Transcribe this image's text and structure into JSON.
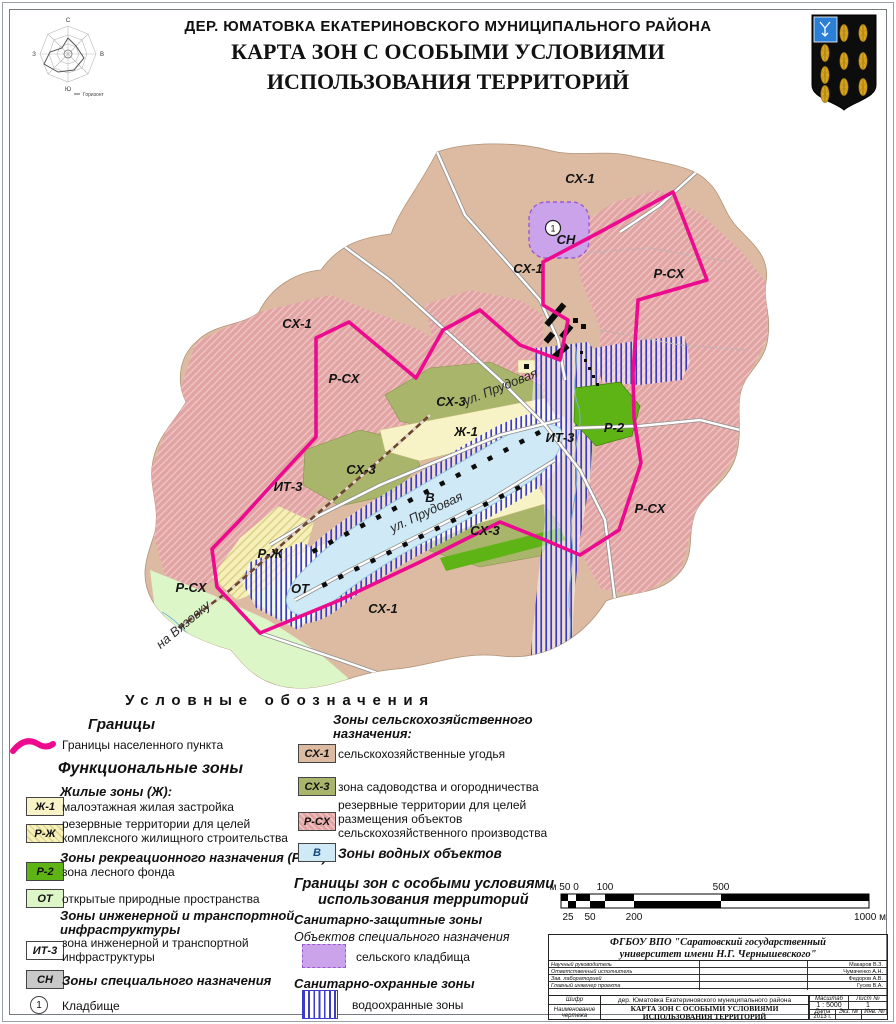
{
  "header": {
    "title_line1": "ДЕР. ЮМАТОВКА ЕКАТЕРИНОВСКОГО МУНИЦИПАЛЬНОГО РАЙОНА",
    "title_line2": "КАРТА ЗОН С ОСОБЫМИ УСЛОВИЯМИ",
    "title_line3": "ИСПОЛЬЗОВАНИЯ ТЕРРИТОРИЙ",
    "windrose": {
      "n": "С",
      "e": "В",
      "s": "Ю",
      "w": "З",
      "caption": "Горизонт"
    }
  },
  "map": {
    "cemetery_marker": "1",
    "labels": [
      {
        "text": "СХ-1",
        "x": 580,
        "y": 53
      },
      {
        "text": "СН",
        "x": 566,
        "y": 114
      },
      {
        "text": "СХ-1",
        "x": 528,
        "y": 143
      },
      {
        "text": "Р-СХ",
        "x": 669,
        "y": 148
      },
      {
        "text": "СХ-1",
        "x": 297,
        "y": 198
      },
      {
        "text": "Р-СХ",
        "x": 344,
        "y": 253
      },
      {
        "text": "СХ-3",
        "x": 451,
        "y": 276
      },
      {
        "text": "Ж-1",
        "x": 466,
        "y": 306
      },
      {
        "text": "ИТ-3",
        "x": 560,
        "y": 312
      },
      {
        "text": "Р-2",
        "x": 614,
        "y": 302
      },
      {
        "text": "СХ-3",
        "x": 361,
        "y": 344
      },
      {
        "text": "ИТ-3",
        "x": 288,
        "y": 361
      },
      {
        "text": "В",
        "x": 430,
        "y": 372
      },
      {
        "text": "СХ-3",
        "x": 485,
        "y": 405
      },
      {
        "text": "Р-СХ",
        "x": 650,
        "y": 383
      },
      {
        "text": "Р-Ж",
        "x": 270,
        "y": 428
      },
      {
        "text": "ОТ",
        "x": 300,
        "y": 463
      },
      {
        "text": "Р-СХ",
        "x": 191,
        "y": 462
      },
      {
        "text": "СХ-1",
        "x": 383,
        "y": 483
      },
      {
        "text": "ул. Прудовая",
        "x": 502,
        "y": 261,
        "rot": -22,
        "size": 6.5,
        "cls": "street"
      },
      {
        "text": "ул. Прудовая",
        "x": 428,
        "y": 386,
        "rot": -25,
        "size": 6.5,
        "cls": "street"
      },
      {
        "text": "на Вязовку",
        "x": 186,
        "y": 498,
        "rot": -40,
        "size": 8,
        "cls": "street"
      }
    ]
  },
  "legend": {
    "header": "Условные обозначения",
    "borders_title": "Границы",
    "border_settlement": "Границы населенного пункта",
    "functional_title": "Функциональные зоны",
    "residential_title": "Жилые зоны (Ж):",
    "zh1_code": "Ж-1",
    "zh1_desc": "малоэтажная жилая застройка",
    "rzh_code": "Р-Ж",
    "rzh_desc1": "резервные территории для целей",
    "rzh_desc2": "комплексного жилищного строительства",
    "recreation_title": "Зоны рекреационного назначения (Р ОТ):",
    "r2_code": "Р-2",
    "r2_desc": "зона лесного фонда",
    "ot_code": "ОТ",
    "ot_desc": "открытые природные пространства",
    "engineering_title1": "Зоны инженерной и транспортной",
    "engineering_title2": "инфраструктуры",
    "it3_code": "ИТ-3",
    "it3_desc1": "зона инженерной и транспортной",
    "it3_desc2": "инфраструктуры",
    "sn_code": "СН",
    "sn_desc": "Зоны специального назначения",
    "cemetery_num": "1",
    "cemetery_desc": "Кладбище",
    "agri_title1": "Зоны сельскохозяйственного",
    "agri_title2": "назначения:",
    "sx1_code": "СХ-1",
    "sx1_desc": "сельскохозяйственные угодья",
    "sx3_code": "СХ-3",
    "sx3_desc": "зона садоводства и огородничества",
    "rsx_code": "Р-СХ",
    "rsx_desc1": "резервные территории для целей",
    "rsx_desc2": "размещения объектов",
    "rsx_desc3": "сельскохозяйственного производства",
    "v_code": "В",
    "v_desc": "Зоны водных объектов",
    "zouit_title1": "Границы зон с особыми условиями",
    "zouit_title2": "использования территорий",
    "sanitary_title": "Санитарно-защитные зоны",
    "special_objects": "Объектов специального назначения",
    "rural_cemetery": "сельского кладбища",
    "sanitary_guard_title": "Санитарно-охранные зоны",
    "water_protection": "водоохранные зоны"
  },
  "scalebar": {
    "top": [
      "м 50",
      "0",
      "100",
      "500"
    ],
    "bottom": [
      "25",
      "50",
      "200",
      "1000 м"
    ]
  },
  "titleblock": {
    "org_line1": "ФГБОУ ВПО \"Саратовский государственный",
    "org_line2": "университет имени Н.Г. Чернышевского\"",
    "roles": [
      {
        "role": "Научный руководитель",
        "name": "Макаров В.З."
      },
      {
        "role": "Ответственный исполнитель",
        "name": "Чумаченко А.Н."
      },
      {
        "role": "Зав. лабораторией",
        "name": "Федоров А.В."
      },
      {
        "role": "Главный инженер проекта",
        "name": "Гусев В.А."
      }
    ],
    "object_label": "Шифр",
    "object_value": "дер. Юматовка Екатериновского муниципального района",
    "drawing_label": "Наименование чертежа",
    "drawing_value_line1": "КАРТА ЗОН С ОСОБЫМИ УСЛОВИЯМИ",
    "drawing_value_line2": "ИСПОЛЬЗОВАНИЯ ТЕРРИТОРИЙ",
    "scale_label": "Масштаб",
    "scale_value": "1 : 5000",
    "sheet_label": "Лист №",
    "sheet_value": "1",
    "date_label": "Дата",
    "date_value": "2013 г.",
    "copy_label": "Экз. №",
    "inv_label": "Инв. №"
  },
  "colors": {
    "boundary_magenta": "#ec0a8e",
    "sx1_tan": "#dcbba2",
    "rsx_pink": "#e2a3a3",
    "sx3_olive": "#a9b56a",
    "zh1_yellow": "#f8f3c6",
    "r2_green": "#5eb414",
    "ot_palegreen": "#dcf6c8",
    "water_blue": "#cfe9f7",
    "cemetery_purple": "#cba3ea",
    "water_stripe_blue": "#3c3ccc",
    "sn_gray": "#c9c9c9"
  }
}
